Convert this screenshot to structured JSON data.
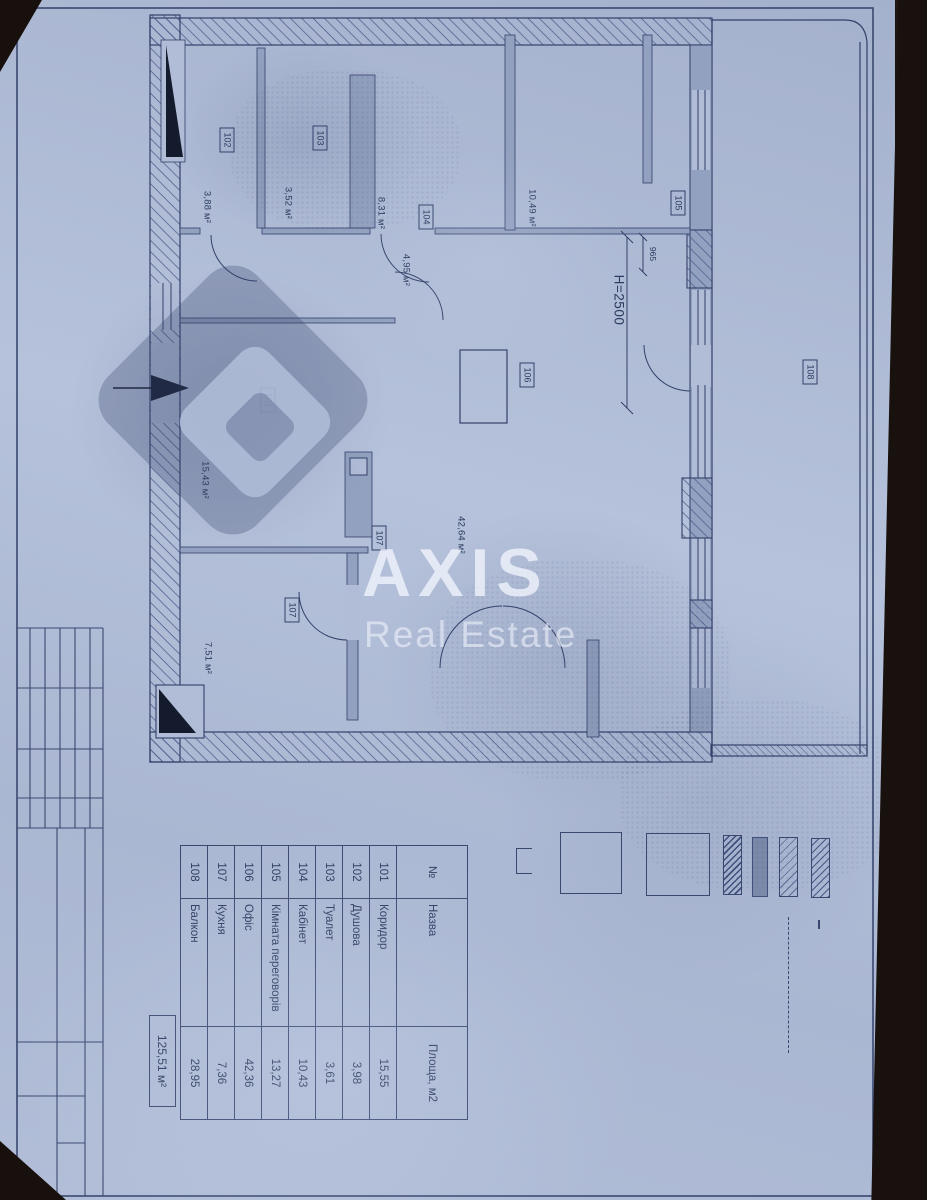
{
  "colors": {
    "paper": "#aebbd6",
    "ink": "#3a4870",
    "photo_background": "#1b1310",
    "wall_fill": "#93a1c0"
  },
  "watermark": {
    "brand": "AXIS",
    "subtitle": "Real Estate"
  },
  "plan": {
    "labels": [
      {
        "text": "101"
      },
      {
        "text": "15,43 м²"
      },
      {
        "text": "102"
      },
      {
        "text": "3,88 м²"
      },
      {
        "text": "103"
      },
      {
        "text": "3,52 м²"
      },
      {
        "text": "104"
      },
      {
        "text": "8,31 м²"
      },
      {
        "text": "4,95 м²"
      },
      {
        "text": "10,49 м²"
      },
      {
        "text": "105"
      },
      {
        "text": "106"
      },
      {
        "text": "42,64 м²"
      },
      {
        "text": "107"
      },
      {
        "text": "107"
      },
      {
        "text": "7,51 м²"
      },
      {
        "text": "108"
      },
      {
        "text": "H=2500"
      },
      {
        "text": "965"
      }
    ]
  },
  "schedule": {
    "header": {
      "num": "№",
      "name": "Назва",
      "area": "Площа, м2"
    },
    "rows": [
      {
        "num": "101",
        "name": "Коридор",
        "area": "15,55"
      },
      {
        "num": "102",
        "name": "Душова",
        "area": "3,98"
      },
      {
        "num": "103",
        "name": "Туалет",
        "area": "3,61"
      },
      {
        "num": "104",
        "name": "Кабінет",
        "area": "10,43"
      },
      {
        "num": "105",
        "name": "Кімната переговорів",
        "area": "13,27"
      },
      {
        "num": "106",
        "name": "Офіс",
        "area": "42,36"
      },
      {
        "num": "107",
        "name": "Кухня",
        "area": "7,36"
      },
      {
        "num": "108",
        "name": "Балкон",
        "area": "28,95"
      }
    ],
    "total": "125,51 м²"
  }
}
